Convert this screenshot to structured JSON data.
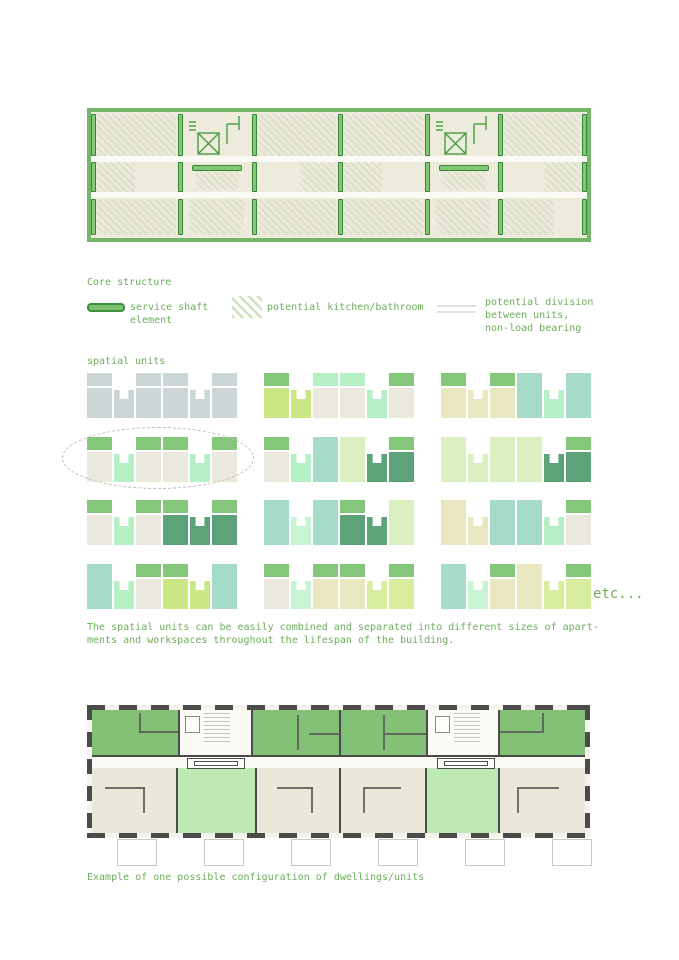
{
  "palette": {
    "text_green": "#6cad5b",
    "plan_frame_green": "#74b768",
    "shaft_fill": "#7cc06e",
    "shaft_stroke": "#3f8f3f",
    "room_green": "#83c276",
    "room_light_green": "#bde9b3",
    "room_beige": "#ebe8da",
    "wall_dark": "#4b4b4b"
  },
  "legend": {
    "title": "Core structure",
    "items": [
      {
        "icon": "service-shaft-icon",
        "label": "service shaft\nelement"
      },
      {
        "icon": "kitchen-bathroom-hatch-icon",
        "label": "potential kitchen/bathroom"
      },
      {
        "icon": "division-lines-icon",
        "label": "potential division\nbetween units,\nnon-load bearing"
      }
    ]
  },
  "spatial_units": {
    "title": "spatial units",
    "etc_label": "etc...",
    "caption": "The spatial units can be easily combined and separated into different sizes of apart-\nments and workspaces throughout the lifespan of the building.",
    "colors": {
      "gray": "#ccd6d6",
      "green": "#84c77b",
      "teal": "#a6dbc9",
      "mint": "#b5efc5",
      "lightmint": "#c9f4d3",
      "beige": "#ebe9de",
      "paleyellow": "#e9e7c0",
      "yellowgreen": "#c9e785",
      "palegreen": "#dbf0c0",
      "limepale": "#d8ee9e",
      "darkgreen": "#5ca379"
    },
    "diagrams": [
      {
        "slots": [
          {
            "t": "tall",
            "cap": "gray",
            "body": "gray"
          },
          {
            "t": "notch",
            "body": "gray"
          },
          {
            "t": "tall",
            "cap": "gray",
            "body": "gray"
          },
          {
            "t": "tall",
            "cap": "gray",
            "body": "gray"
          },
          {
            "t": "notch",
            "body": "gray"
          },
          {
            "t": "tall",
            "cap": "gray",
            "body": "gray"
          }
        ]
      },
      {
        "slots": [
          {
            "t": "tall",
            "cap": "green",
            "body": "yellowgreen"
          },
          {
            "t": "notch",
            "body": "yellowgreen"
          },
          {
            "t": "tall",
            "cap": "mint",
            "body": "beige"
          },
          {
            "t": "tall",
            "cap": "mint",
            "body": "beige"
          },
          {
            "t": "notch",
            "body": "mint"
          },
          {
            "t": "tall",
            "cap": "green",
            "body": "beige"
          }
        ]
      },
      {
        "slots": [
          {
            "t": "tall",
            "cap": "green",
            "body": "paleyellow"
          },
          {
            "t": "notch",
            "body": "paleyellow"
          },
          {
            "t": "tall",
            "cap": "green",
            "body": "paleyellow"
          },
          {
            "t": "full",
            "body": "teal"
          },
          {
            "t": "notch",
            "body": "mint"
          },
          {
            "t": "full",
            "body": "teal"
          }
        ]
      },
      {
        "slots": [
          {
            "t": "tall",
            "cap": "green",
            "body": "beige"
          },
          {
            "t": "notch",
            "body": "mint"
          },
          {
            "t": "tall",
            "cap": "green",
            "body": "beige"
          },
          {
            "t": "tall",
            "cap": "green",
            "body": "beige"
          },
          {
            "t": "notch",
            "body": "mint"
          },
          {
            "t": "tall",
            "cap": "green",
            "body": "beige"
          }
        ]
      },
      {
        "slots": [
          {
            "t": "tall",
            "cap": "green",
            "body": "beige"
          },
          {
            "t": "notch",
            "body": "mint"
          },
          {
            "t": "full",
            "body": "teal"
          },
          {
            "t": "full",
            "body": "palegreen"
          },
          {
            "t": "notch",
            "body": "darkgreen"
          },
          {
            "t": "tall",
            "cap": "green",
            "body": "darkgreen"
          }
        ]
      },
      {
        "slots": [
          {
            "t": "full",
            "body": "palegreen"
          },
          {
            "t": "notch",
            "body": "palegreen"
          },
          {
            "t": "full",
            "body": "palegreen"
          },
          {
            "t": "full",
            "body": "palegreen"
          },
          {
            "t": "notch",
            "body": "darkgreen"
          },
          {
            "t": "tall",
            "cap": "green",
            "body": "darkgreen"
          }
        ]
      },
      {
        "slots": [
          {
            "t": "tall",
            "cap": "green",
            "body": "beige"
          },
          {
            "t": "notch",
            "body": "mint"
          },
          {
            "t": "tall",
            "cap": "green",
            "body": "beige"
          },
          {
            "t": "tall",
            "cap": "green",
            "body": "darkgreen"
          },
          {
            "t": "notch",
            "body": "darkgreen"
          },
          {
            "t": "tall",
            "cap": "green",
            "body": "darkgreen"
          }
        ]
      },
      {
        "slots": [
          {
            "t": "full",
            "body": "teal"
          },
          {
            "t": "notch",
            "body": "lightmint"
          },
          {
            "t": "full",
            "body": "teal"
          },
          {
            "t": "tall",
            "cap": "green",
            "body": "darkgreen"
          },
          {
            "t": "notch",
            "body": "darkgreen"
          },
          {
            "t": "full",
            "body": "palegreen"
          }
        ]
      },
      {
        "slots": [
          {
            "t": "full",
            "body": "paleyellow"
          },
          {
            "t": "notch",
            "body": "paleyellow"
          },
          {
            "t": "full",
            "body": "teal"
          },
          {
            "t": "full",
            "body": "teal"
          },
          {
            "t": "notch",
            "body": "mint"
          },
          {
            "t": "tall",
            "cap": "green",
            "body": "beige"
          }
        ]
      },
      {
        "slots": [
          {
            "t": "full",
            "body": "teal"
          },
          {
            "t": "notch",
            "body": "mint"
          },
          {
            "t": "tall",
            "cap": "green",
            "body": "beige"
          },
          {
            "t": "tall",
            "cap": "green",
            "body": "yellowgreen"
          },
          {
            "t": "notch",
            "body": "yellowgreen"
          },
          {
            "t": "full",
            "body": "teal"
          }
        ]
      },
      {
        "slots": [
          {
            "t": "tall",
            "cap": "green",
            "body": "beige"
          },
          {
            "t": "notch",
            "body": "lightmint"
          },
          {
            "t": "tall",
            "cap": "green",
            "body": "paleyellow"
          },
          {
            "t": "tall",
            "cap": "green",
            "body": "paleyellow"
          },
          {
            "t": "notch",
            "body": "limepale"
          },
          {
            "t": "tall",
            "cap": "green",
            "body": "limepale"
          }
        ]
      },
      {
        "slots": [
          {
            "t": "full",
            "body": "teal"
          },
          {
            "t": "notch",
            "body": "lightmint"
          },
          {
            "t": "tall",
            "cap": "green",
            "body": "paleyellow"
          },
          {
            "t": "full",
            "body": "paleyellow"
          },
          {
            "t": "notch",
            "body": "limepale"
          },
          {
            "t": "tall",
            "cap": "green",
            "body": "limepale"
          }
        ]
      }
    ]
  },
  "bottom_plan": {
    "caption": "Example of one possible configuration of dwellings/units"
  }
}
